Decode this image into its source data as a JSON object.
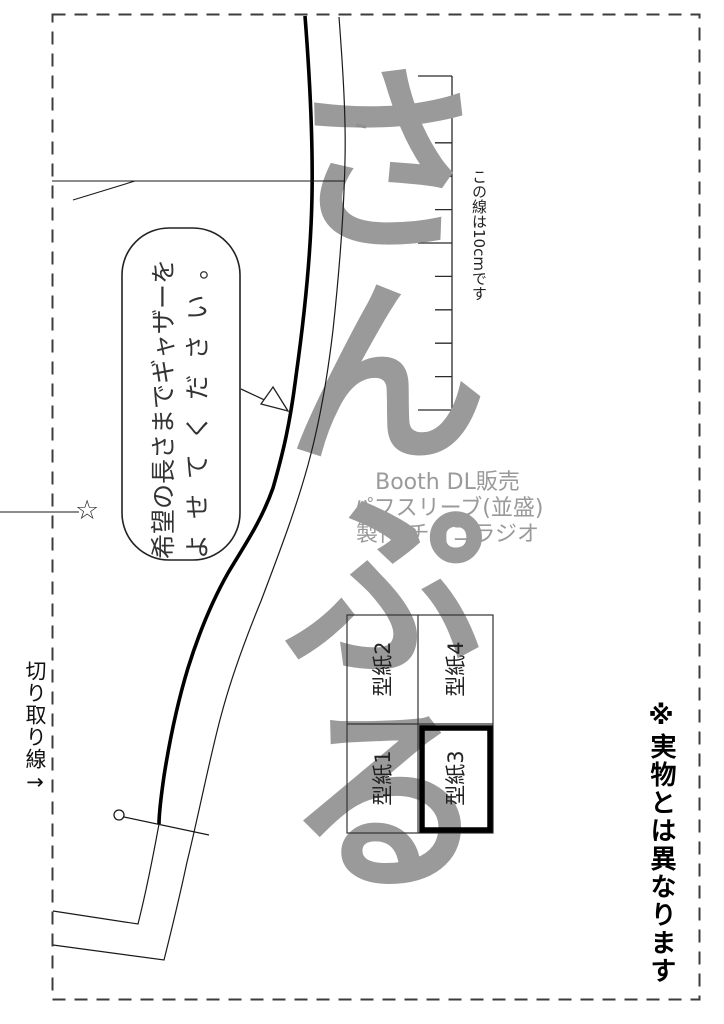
{
  "watermark": {
    "text": "さんぷる",
    "color": "#9a9a9a"
  },
  "cut_line": {
    "label": "切り取り線→"
  },
  "star": {
    "glyph": "☆"
  },
  "bubble": {
    "line1": "希望の長さまでギャザーを",
    "line2": "よせてください。"
  },
  "ruler": {
    "label": "この線は10cmです",
    "ticks_cm": 10
  },
  "credit": {
    "line1": "Booth DL販売",
    "line2": "パフスリーブ(並盛)",
    "line3": "製作:チョコラジオ",
    "color": "#9a9a9a"
  },
  "pieces": [
    {
      "label": "型紙1"
    },
    {
      "label": "型紙2"
    },
    {
      "label": "型紙3"
    },
    {
      "label": "型紙4"
    }
  ],
  "disclaimer": {
    "text": "※実物とは異なります"
  }
}
